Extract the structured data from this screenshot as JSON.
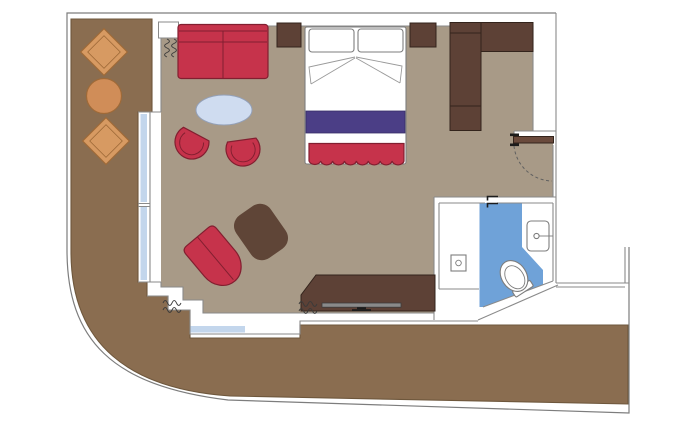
{
  "meta": {
    "title": "Cabin floor plan",
    "type": "floor-plan",
    "rooms": [
      "wrap-around-balcony",
      "living-sleeping-area",
      "entry-vestibule",
      "bathroom"
    ],
    "furniture": [
      "balcony-lounge-chair",
      "balcony-lounge-chair",
      "balcony-round-table",
      "sofa",
      "oval-coffee-table",
      "tub-chair",
      "tub-chair",
      "chaise-armchair",
      "ottoman",
      "double-bed",
      "pillow",
      "pillow",
      "bed-runner",
      "foot-blanket",
      "nightstand",
      "nightstand",
      "wardrobe",
      "desk-tv-console",
      "tv"
    ],
    "fixtures": [
      "entry-door",
      "door-swing-arc",
      "bathroom-sliding-door",
      "sink",
      "toilet",
      "shower-drain",
      "curtains",
      "glass-windows"
    ]
  },
  "colors": {
    "background": "#ffffff",
    "outline": "#8a8a8a",
    "hull_line": "#7d7d7d",
    "deck": "#8a6d50",
    "deck_edge": "#6e573c",
    "floor": "#a89a87",
    "glass": "#c3d6ec",
    "red": "#c6334b",
    "red_dark": "#821f30",
    "terracotta": "#d79a62",
    "terracotta_dark": "#9f6a38",
    "table_tan": "#d08d58",
    "wood": "#5d4136",
    "wood_dark": "#33241c",
    "door_wood": "#6a4a3c",
    "ottoman": "#5f4537",
    "purple": "#4b3e86",
    "purple_dark": "#372e66",
    "oval": "#cfdcf0",
    "oval_dark": "#93a0b8",
    "bath_blue": "#6fa2d8",
    "fixture_line": "#7d7d7d",
    "tv": "#8a8a8a",
    "tv_dark": "#3c3c3c",
    "curtain": "#3a3a3a",
    "black": "#1c1c1c",
    "dash": "#5f5f5f"
  }
}
